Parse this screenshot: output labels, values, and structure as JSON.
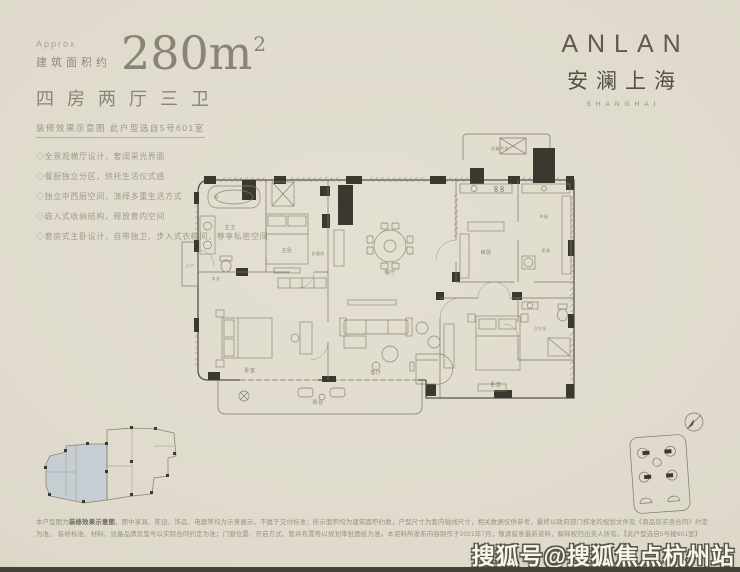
{
  "header": {
    "approx": "Approx",
    "area_label": "建筑面积约",
    "area_value": "280m",
    "area_unit_sup": "2",
    "layout": "四房两厅三卫",
    "subtitle": "装修效果示意图 此户型选自5号601室",
    "bullets": [
      "◇全景观横厅设计，奢阔采光界面",
      "◇餐厨独立分区，烘托生活仪式感",
      "◇独立中西厨空间，演绎多重生活方式",
      "◇嵌入式收纳结构，释放套内空间",
      "◇套房式主卧设计，自带独卫、步入式衣帽间，尊享私密空间"
    ]
  },
  "logo": {
    "latin": "ANLAN",
    "cn": "安澜上海",
    "city": "SHANGHAI"
  },
  "plan": {
    "labels": [
      {
        "t": "主卫",
        "x": 52,
        "y": 107
      },
      {
        "t": "主卧",
        "x": 109,
        "y": 130
      },
      {
        "t": "衣帽间",
        "x": 140,
        "y": 133
      },
      {
        "t": "餐厅",
        "x": 212,
        "y": 152
      },
      {
        "t": "西厨",
        "x": 308,
        "y": 132
      },
      {
        "t": "中厨",
        "x": 366,
        "y": 96
      },
      {
        "t": "家政",
        "x": 368,
        "y": 130
      },
      {
        "t": "客厅",
        "x": 198,
        "y": 252
      },
      {
        "t": "阳台",
        "x": 140,
        "y": 282
      },
      {
        "t": "卧室",
        "x": 72,
        "y": 250
      },
      {
        "t": "卧室",
        "x": 318,
        "y": 264
      },
      {
        "t": "卫生间",
        "x": 362,
        "y": 208
      },
      {
        "t": "玄关",
        "x": 38,
        "y": 158
      },
      {
        "t": "入户",
        "x": 12,
        "y": 145
      },
      {
        "t": "设备平台",
        "x": 322,
        "y": 28
      }
    ]
  },
  "footer": {
    "d1_pre": "本户型图为",
    "d1_bold": "装修效果示意图",
    "d1_rest": "，图中家具、陈设、饰品、电器等均为示意展示，不属于交付标准；所示面积均为建筑面积约数，户型尺寸为套内轴线尺寸，相关数据仅供参考，最终以政府部门核准的规划文件及《商品房买卖合同》约定为准。",
    "d2": "装修标准、材料、设备品牌及型号以实际合同约定为准；门窗位置、开启方式、管井布置等以规划审批图纸为准。本资料所发布内容制作于2021年7月，敬请留意最新资料，解释权归出卖人所有。【此户型选自5号楼601室】"
  },
  "watermark": "搜狐号@搜狐焦点杭州站"
}
